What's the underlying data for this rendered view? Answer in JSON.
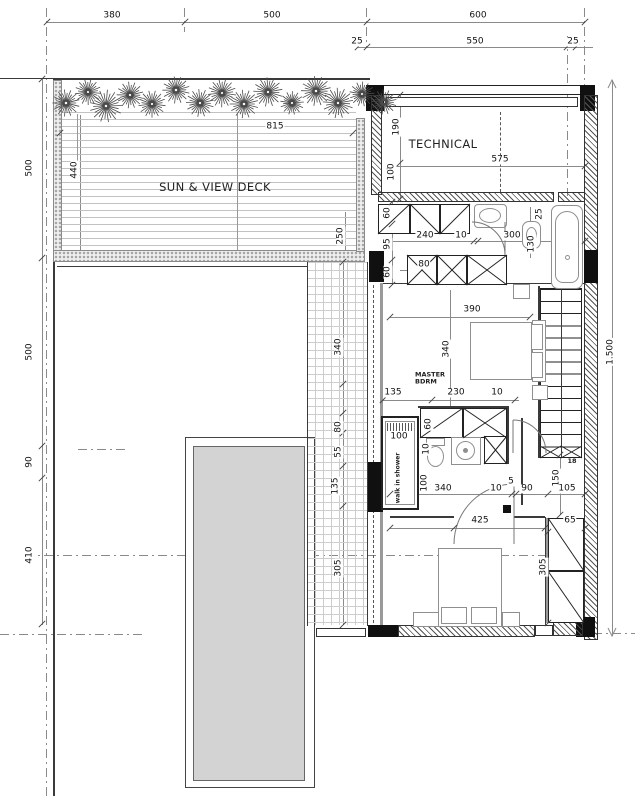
{
  "labels": {
    "deck": "SUN & VIEW DECK",
    "technical": "TECHNICAL",
    "master_line1": "MASTER",
    "master_line2": "BDRM",
    "walk_in_shower": "walk in shower",
    "stair_count": "18"
  },
  "colors": {
    "wall_line": "#2a2a2a",
    "lower_roof_fill": "#d3d3d3",
    "tree": "#4a4a4a",
    "tile_line": "#cdcdcd"
  },
  "dimensions": [
    {
      "t": "380",
      "x": 112,
      "y": 16,
      "v": 0
    },
    {
      "t": "500",
      "x": 272,
      "y": 16,
      "v": 0
    },
    {
      "t": "600",
      "x": 478,
      "y": 16,
      "v": 0
    },
    {
      "t": "25",
      "x": 357,
      "y": 42,
      "v": 0
    },
    {
      "t": "550",
      "x": 475,
      "y": 42,
      "v": 0
    },
    {
      "t": "25",
      "x": 573,
      "y": 42,
      "v": 0
    },
    {
      "t": "500",
      "x": 30,
      "y": 168,
      "v": 1
    },
    {
      "t": "500",
      "x": 30,
      "y": 352,
      "v": 1
    },
    {
      "t": "90",
      "x": 30,
      "y": 462,
      "v": 1
    },
    {
      "t": "410",
      "x": 30,
      "y": 555,
      "v": 1
    },
    {
      "t": "1.500",
      "x": 611,
      "y": 352,
      "v": 1
    },
    {
      "t": "815",
      "x": 275,
      "y": 127,
      "v": 0
    },
    {
      "t": "440",
      "x": 75,
      "y": 170,
      "v": 1
    },
    {
      "t": "250",
      "x": 341,
      "y": 236,
      "v": 1
    },
    {
      "t": "575",
      "x": 500,
      "y": 160,
      "v": 0
    },
    {
      "t": "190",
      "x": 397,
      "y": 127,
      "v": 1
    },
    {
      "t": "100",
      "x": 392,
      "y": 172,
      "v": 1
    },
    {
      "t": "60",
      "x": 388,
      "y": 213,
      "v": 1
    },
    {
      "t": "95",
      "x": 388,
      "y": 244,
      "v": 1
    },
    {
      "t": "60",
      "x": 388,
      "y": 272,
      "v": 1
    },
    {
      "t": "240",
      "x": 425,
      "y": 236,
      "v": 0
    },
    {
      "t": "10",
      "x": 461,
      "y": 236,
      "v": 0
    },
    {
      "t": "300",
      "x": 512,
      "y": 236,
      "v": 0
    },
    {
      "t": "25",
      "x": 540,
      "y": 214,
      "v": 1
    },
    {
      "t": "130",
      "x": 532,
      "y": 244,
      "v": 1
    },
    {
      "t": "80",
      "x": 424,
      "y": 265,
      "v": 0
    },
    {
      "t": "390",
      "x": 472,
      "y": 310,
      "v": 0
    },
    {
      "t": "340",
      "x": 447,
      "y": 349,
      "v": 1
    },
    {
      "t": "135",
      "x": 393,
      "y": 393,
      "v": 0
    },
    {
      "t": "230",
      "x": 456,
      "y": 393,
      "v": 0
    },
    {
      "t": "10",
      "x": 497,
      "y": 393,
      "v": 0
    },
    {
      "t": "340",
      "x": 339,
      "y": 347,
      "v": 1
    },
    {
      "t": "80",
      "x": 339,
      "y": 427,
      "v": 1
    },
    {
      "t": "55",
      "x": 339,
      "y": 452,
      "v": 1
    },
    {
      "t": "135",
      "x": 336,
      "y": 486,
      "v": 1
    },
    {
      "t": "305",
      "x": 339,
      "y": 568,
      "v": 1
    },
    {
      "t": "100",
      "x": 399,
      "y": 437,
      "v": 0
    },
    {
      "t": "60",
      "x": 429,
      "y": 424,
      "v": 1
    },
    {
      "t": "10",
      "x": 427,
      "y": 449,
      "v": 1
    },
    {
      "t": "100",
      "x": 425,
      "y": 483,
      "v": 1
    },
    {
      "t": "340",
      "x": 443,
      "y": 489,
      "v": 0
    },
    {
      "t": "10",
      "x": 496,
      "y": 489,
      "v": 0
    },
    {
      "t": "5",
      "x": 511,
      "y": 482,
      "v": 0
    },
    {
      "t": "90",
      "x": 527,
      "y": 489,
      "v": 0
    },
    {
      "t": "150",
      "x": 557,
      "y": 478,
      "v": 1
    },
    {
      "t": "105",
      "x": 567,
      "y": 489,
      "v": 0
    },
    {
      "t": "425",
      "x": 480,
      "y": 521,
      "v": 0
    },
    {
      "t": "65",
      "x": 570,
      "y": 521,
      "v": 0
    },
    {
      "t": "305",
      "x": 544,
      "y": 567,
      "v": 1
    }
  ],
  "ticks": [
    [
      47,
      22
    ],
    [
      185,
      22
    ],
    [
      367,
      22
    ],
    [
      585,
      22
    ],
    [
      358,
      47
    ],
    [
      367,
      47
    ],
    [
      567,
      47
    ],
    [
      576,
      47
    ],
    [
      42,
      79
    ],
    [
      42,
      258
    ],
    [
      42,
      446
    ],
    [
      42,
      478
    ],
    [
      42,
      624
    ],
    [
      60,
      133
    ],
    [
      353,
      133
    ],
    [
      390,
      166
    ],
    [
      585,
      166
    ],
    [
      400,
      95
    ],
    [
      400,
      163
    ],
    [
      400,
      199
    ],
    [
      388,
      241
    ],
    [
      474,
      241
    ],
    [
      478,
      241
    ],
    [
      585,
      241
    ],
    [
      392,
      202
    ],
    [
      392,
      224
    ],
    [
      392,
      260
    ],
    [
      392,
      285
    ],
    [
      390,
      317
    ],
    [
      530,
      317
    ],
    [
      383,
      400
    ],
    [
      432,
      400
    ],
    [
      515,
      400
    ],
    [
      343,
      262
    ],
    [
      343,
      384
    ],
    [
      343,
      413
    ],
    [
      343,
      433
    ],
    [
      343,
      466
    ],
    [
      343,
      506
    ],
    [
      343,
      625
    ],
    [
      390,
      494
    ],
    [
      512,
      494
    ],
    [
      516,
      494
    ],
    [
      548,
      494
    ],
    [
      585,
      494
    ],
    [
      390,
      528
    ],
    [
      454,
      528
    ],
    [
      545,
      528
    ],
    [
      585,
      528
    ],
    [
      548,
      532
    ],
    [
      548,
      623
    ],
    [
      560,
      455
    ],
    [
      560,
      515
    ]
  ],
  "trees": [
    {
      "x": 66,
      "y": 103,
      "r": 15
    },
    {
      "x": 88,
      "y": 92,
      "r": 13
    },
    {
      "x": 106,
      "y": 106,
      "r": 15
    },
    {
      "x": 130,
      "y": 95,
      "r": 14
    },
    {
      "x": 152,
      "y": 104,
      "r": 13
    },
    {
      "x": 176,
      "y": 90,
      "r": 15
    },
    {
      "x": 200,
      "y": 103,
      "r": 14
    },
    {
      "x": 222,
      "y": 93,
      "r": 13
    },
    {
      "x": 244,
      "y": 104,
      "r": 15
    },
    {
      "x": 268,
      "y": 92,
      "r": 14
    },
    {
      "x": 292,
      "y": 103,
      "r": 13
    },
    {
      "x": 316,
      "y": 91,
      "r": 15
    },
    {
      "x": 338,
      "y": 103,
      "r": 14
    },
    {
      "x": 362,
      "y": 94,
      "r": 13
    },
    {
      "x": 384,
      "y": 102,
      "r": 12
    }
  ]
}
